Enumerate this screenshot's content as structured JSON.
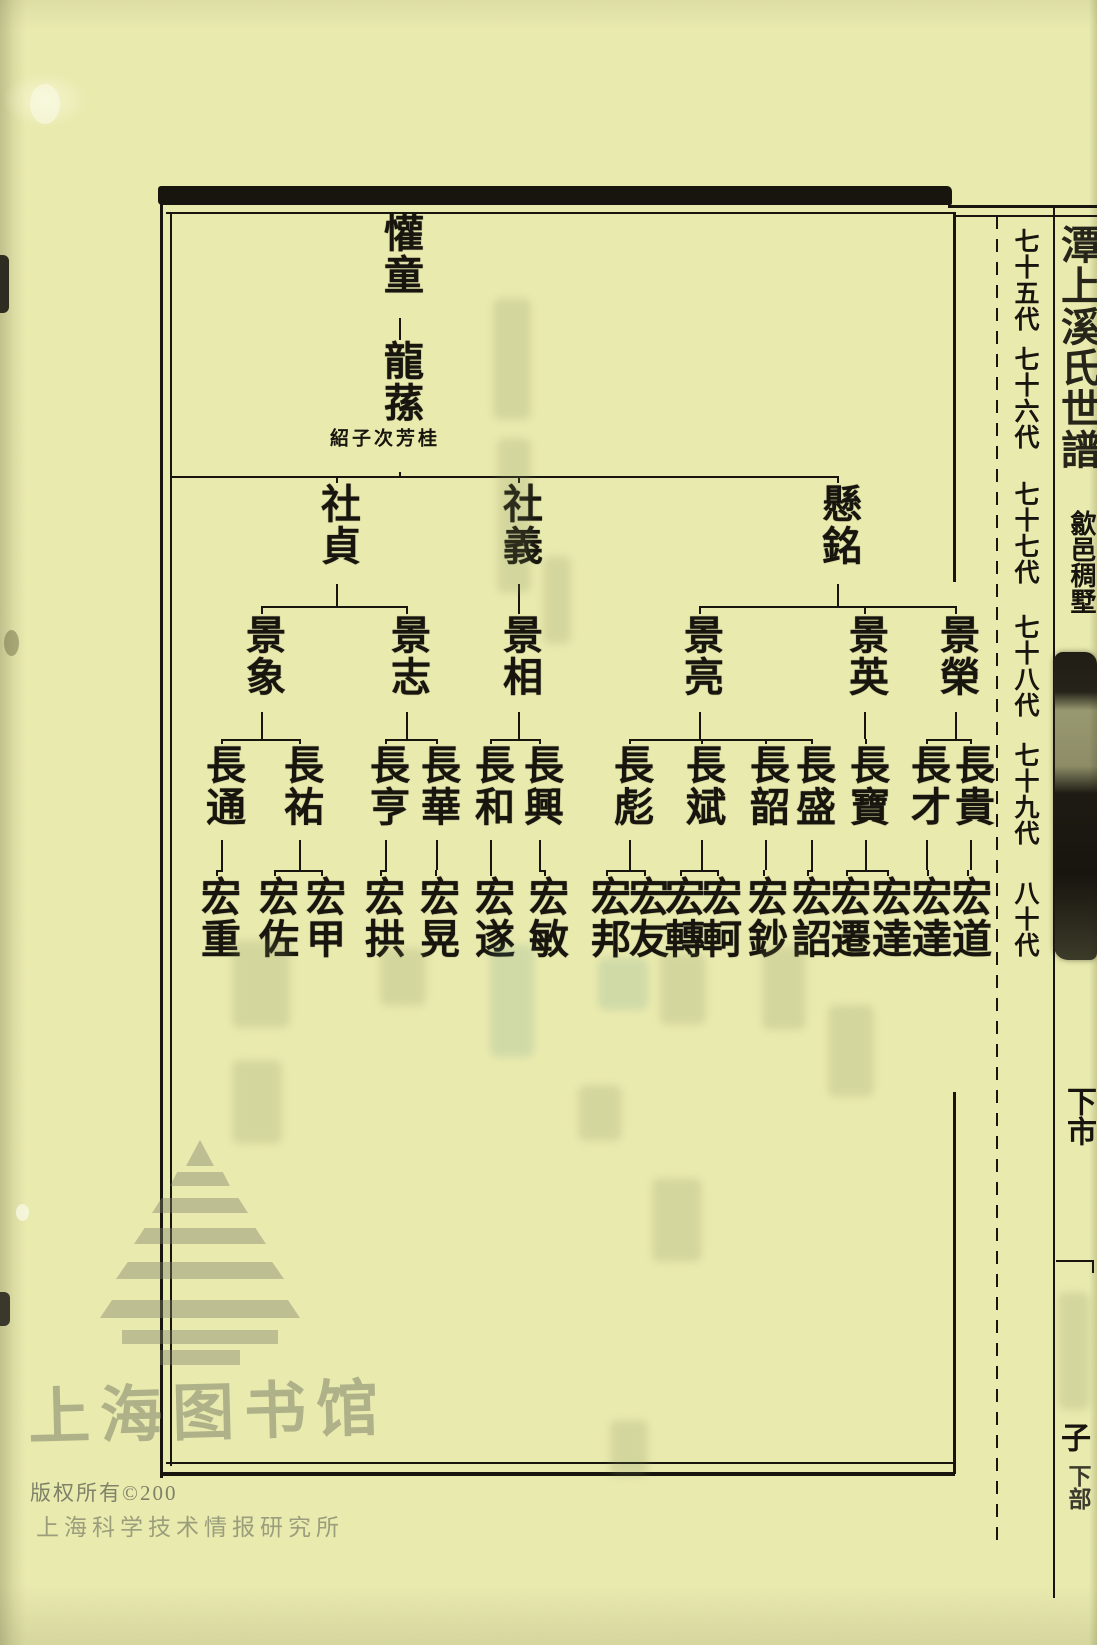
{
  "page": {
    "paper_color": "#e9eaae",
    "ink_color": "#17150e"
  },
  "generation_column": {
    "labels": [
      {
        "text": "七十五代",
        "y": 228
      },
      {
        "text": "七十六代",
        "y": 346
      },
      {
        "text": "七十七代",
        "y": 481
      },
      {
        "text": "七十八代",
        "y": 614
      },
      {
        "text": "七十九代",
        "y": 742
      },
      {
        "text": "八十代",
        "y": 880
      }
    ]
  },
  "title_strip": {
    "book_title": "潭上溪氏世譜",
    "location": "歙邑稠墅",
    "section_label": "下市",
    "bottom_char": "子",
    "bottom_label": "下部"
  },
  "footer": {
    "library_watermark": "上海图书馆",
    "copyright_line": "版权所有©200",
    "institute_line": "上海科学技术情报研究所"
  },
  "tree": {
    "rows": [
      {
        "top": 212,
        "bottom": 318,
        "branch_y": null
      },
      {
        "top": 340,
        "bottom": 472,
        "branch_y": null
      },
      {
        "top": 483,
        "bottom": 584,
        "branch_y": 476
      },
      {
        "top": 614,
        "bottom": 712,
        "branch_y": 606
      },
      {
        "top": 744,
        "bottom": 840,
        "branch_y": 739
      },
      {
        "top": 876,
        "bottom": 976,
        "branch_y": 870
      }
    ],
    "bus": {
      "y": 476,
      "x1": 172,
      "x2": 838
    },
    "nodes": [
      {
        "id": "huantong",
        "label": "懽童",
        "gen": 0,
        "x": 400,
        "parent": null
      },
      {
        "id": "longsun",
        "label": "龍蓀",
        "gen": 1,
        "x": 400,
        "parent": "huantong",
        "annotation": "桂芳次\n子紹"
      },
      {
        "id": "shezhen",
        "label": "社貞",
        "gen": 2,
        "x": 337,
        "parent": "longsun"
      },
      {
        "id": "sheyi",
        "label": "社義",
        "gen": 2,
        "x": 519,
        "parent": "longsun"
      },
      {
        "id": "xuanming",
        "label": "懸銘",
        "gen": 2,
        "x": 838,
        "parent": "longsun"
      },
      {
        "id": "jingxiang",
        "label": "景象",
        "gen": 3,
        "x": 262,
        "parent": "shezhen"
      },
      {
        "id": "jingzhi",
        "label": "景志",
        "gen": 3,
        "x": 407,
        "parent": "shezhen"
      },
      {
        "id": "jingxiang2",
        "label": "景相",
        "gen": 3,
        "x": 519,
        "parent": "sheyi"
      },
      {
        "id": "jingliang",
        "label": "景亮",
        "gen": 3,
        "x": 700,
        "parent": "xuanming"
      },
      {
        "id": "jingying",
        "label": "景英",
        "gen": 3,
        "x": 865,
        "parent": "xuanming"
      },
      {
        "id": "jingrong",
        "label": "景榮",
        "gen": 3,
        "x": 956,
        "parent": "xuanming"
      },
      {
        "id": "changtong",
        "label": "長通",
        "gen": 4,
        "x": 222,
        "parent": "jingxiang"
      },
      {
        "id": "changyou",
        "label": "長祐",
        "gen": 4,
        "x": 300,
        "parent": "jingxiang"
      },
      {
        "id": "changheng",
        "label": "長亨",
        "gen": 4,
        "x": 386,
        "parent": "jingzhi"
      },
      {
        "id": "changhua",
        "label": "長華",
        "gen": 4,
        "x": 437,
        "parent": "jingzhi"
      },
      {
        "id": "changhe",
        "label": "長和",
        "gen": 4,
        "x": 491,
        "parent": "jingxiang2"
      },
      {
        "id": "changxing",
        "label": "長興",
        "gen": 4,
        "x": 540,
        "parent": "jingxiang2"
      },
      {
        "id": "changbiao",
        "label": "長彪",
        "gen": 4,
        "x": 630,
        "parent": "jingliang"
      },
      {
        "id": "changbin",
        "label": "長斌",
        "gen": 4,
        "x": 702,
        "parent": "jingliang"
      },
      {
        "id": "changshao",
        "label": "長韶",
        "gen": 4,
        "x": 766,
        "parent": "jingliang"
      },
      {
        "id": "changsheng",
        "label": "長盛",
        "gen": 4,
        "x": 812,
        "parent": "jingliang"
      },
      {
        "id": "changbao",
        "label": "長寶",
        "gen": 4,
        "x": 866,
        "parent": "jingying"
      },
      {
        "id": "changcai",
        "label": "長才",
        "gen": 4,
        "x": 927,
        "parent": "jingrong"
      },
      {
        "id": "changgui",
        "label": "長貴",
        "gen": 4,
        "x": 971,
        "parent": "jingrong"
      },
      {
        "id": "hongzhong",
        "label": "宏重",
        "gen": 5,
        "x": 217,
        "parent": "changtong"
      },
      {
        "id": "hongzuo",
        "label": "宏佐",
        "gen": 5,
        "x": 275,
        "parent": "changyou"
      },
      {
        "id": "hongjia",
        "label": "宏甲",
        "gen": 5,
        "x": 322,
        "parent": "changyou"
      },
      {
        "id": "honggong",
        "label": "宏拱",
        "gen": 5,
        "x": 381,
        "parent": "changheng"
      },
      {
        "id": "honghuang",
        "label": "宏晃",
        "gen": 5,
        "x": 436,
        "parent": "changhua"
      },
      {
        "id": "hongsui",
        "label": "宏遂",
        "gen": 5,
        "x": 491,
        "parent": "changhe"
      },
      {
        "id": "hongmin",
        "label": "宏敏",
        "gen": 5,
        "x": 545,
        "parent": "changxing"
      },
      {
        "id": "hongbang",
        "label": "宏邦",
        "gen": 5,
        "x": 607,
        "parent": "changbiao"
      },
      {
        "id": "hongyou",
        "label": "宏友",
        "gen": 5,
        "x": 645,
        "parent": "changbiao"
      },
      {
        "id": "hongzhuan",
        "label": "宏轉",
        "gen": 5,
        "x": 681,
        "parent": "changbin"
      },
      {
        "id": "hongke",
        "label": "宏軻",
        "gen": 5,
        "x": 718,
        "parent": "changbin"
      },
      {
        "id": "hongchao",
        "label": "宏鈔",
        "gen": 5,
        "x": 764,
        "parent": "changshao"
      },
      {
        "id": "hongzhao",
        "label": "宏詔",
        "gen": 5,
        "x": 808,
        "parent": "changsheng"
      },
      {
        "id": "hongqian",
        "label": "宏遷",
        "gen": 5,
        "x": 847,
        "parent": "changbao"
      },
      {
        "id": "hongda",
        "label": "宏達",
        "gen": 5,
        "x": 888,
        "parent": "changbao"
      },
      {
        "id": "hongda2",
        "label": "宏達",
        "gen": 5,
        "x": 928,
        "parent": "changcai"
      },
      {
        "id": "hongdao",
        "label": "宏道",
        "gen": 5,
        "x": 968,
        "parent": "changgui"
      }
    ]
  }
}
